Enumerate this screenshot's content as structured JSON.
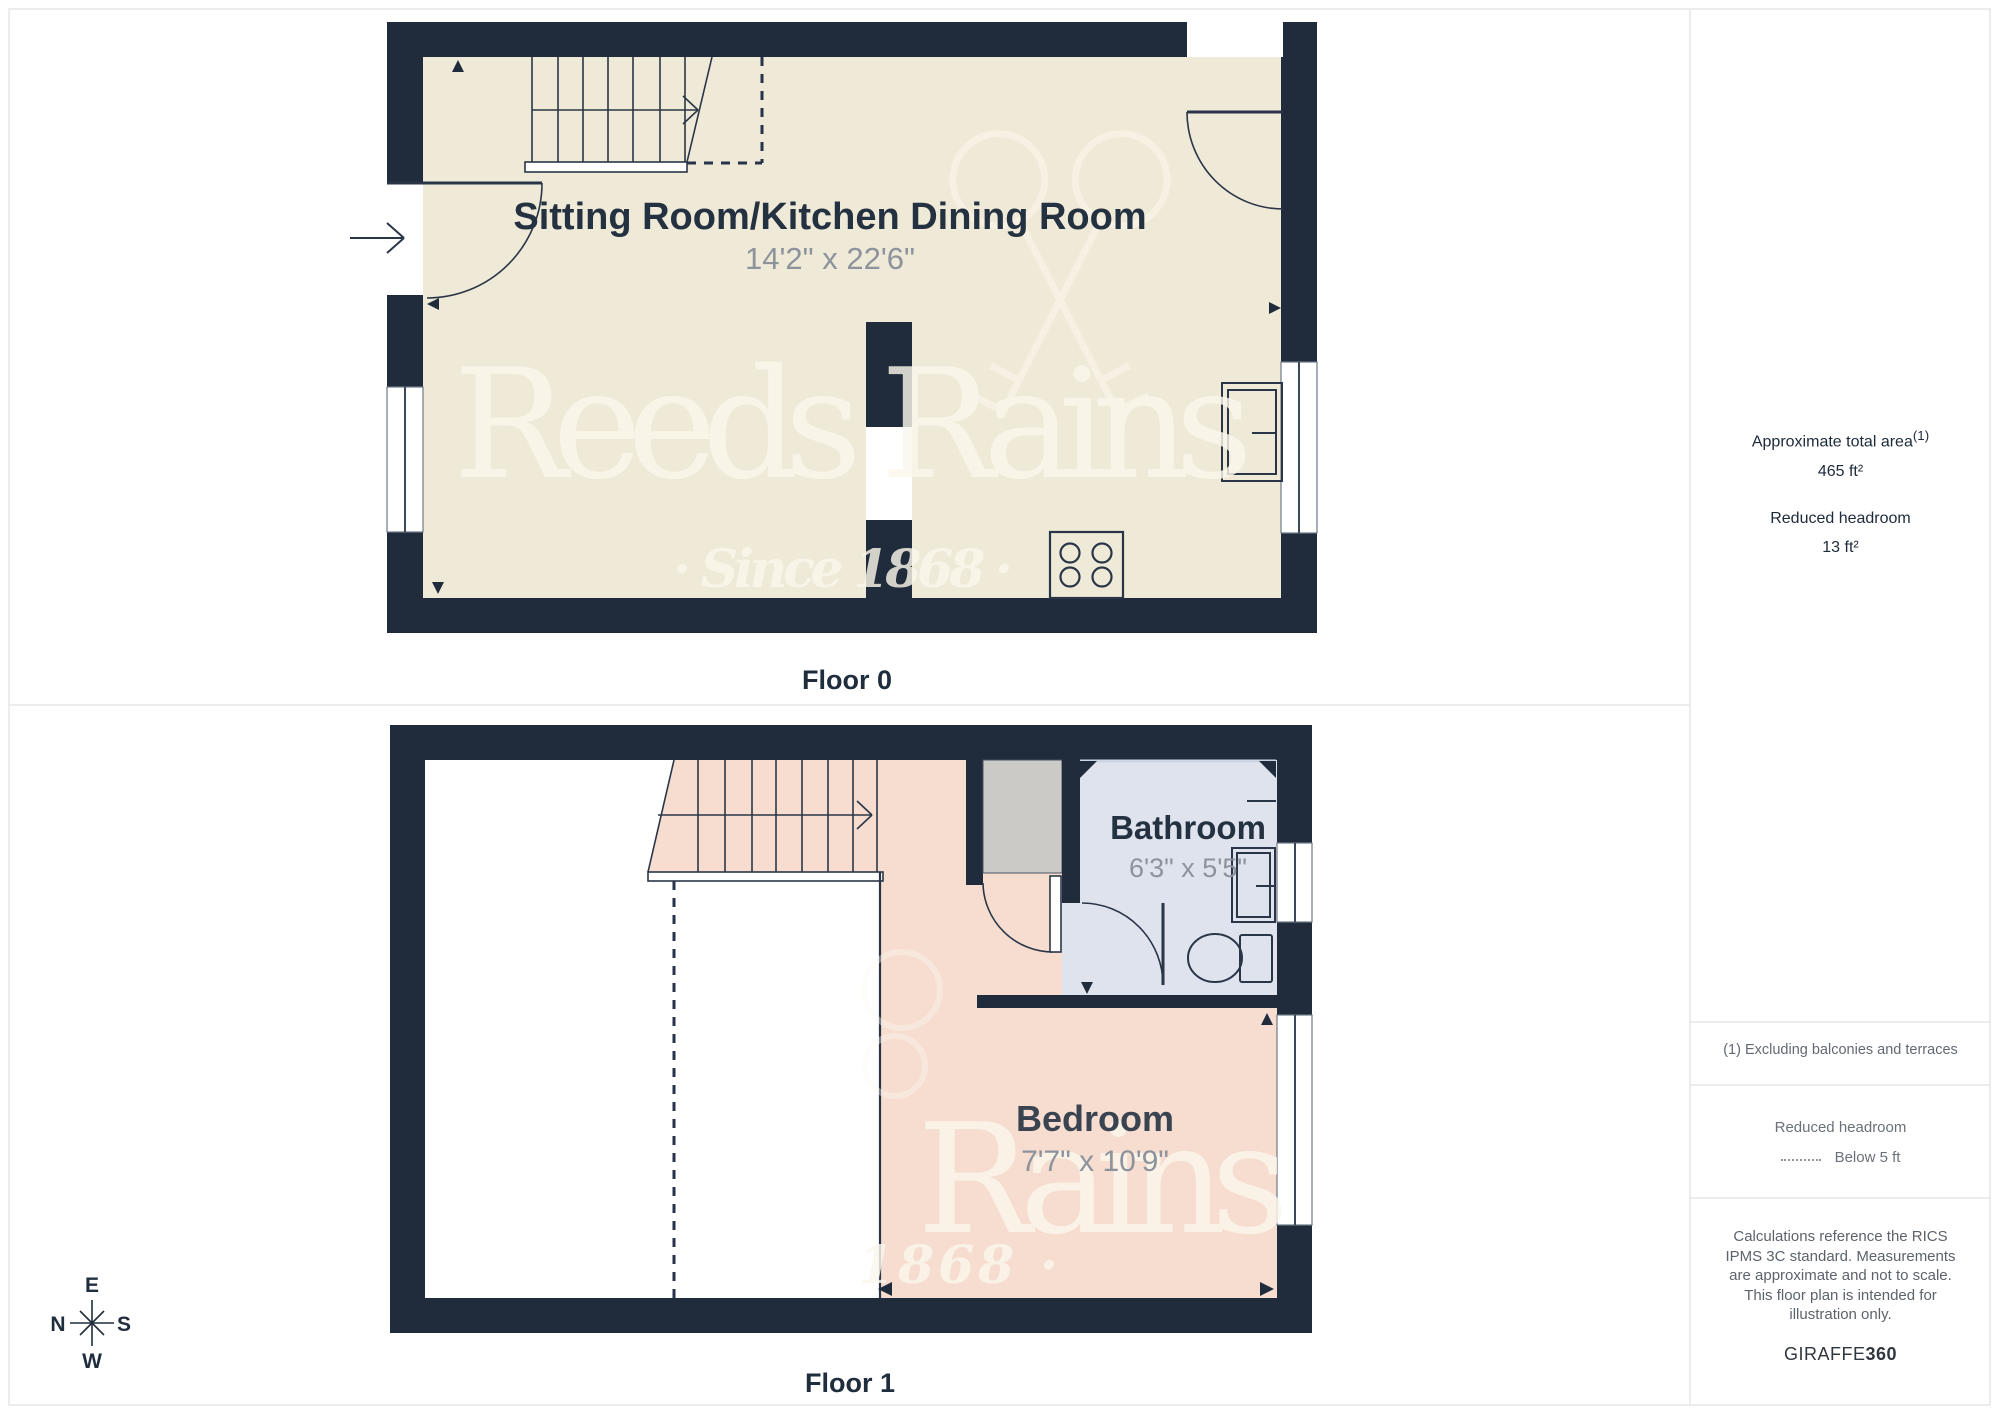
{
  "floors": {
    "floor0": {
      "label": "Floor 0",
      "room": {
        "name": "Sitting Room/Kitchen Dining Room",
        "dims": "14'2\" x 22'6\""
      }
    },
    "floor1": {
      "label": "Floor 1",
      "bathroom": {
        "name": "Bathroom",
        "dims": "6'3\" x 5'5\""
      },
      "bedroom": {
        "name": "Bedroom",
        "dims": "7'7\" x 10'9\""
      }
    }
  },
  "compass": {
    "top": "E",
    "left": "N",
    "right": "S",
    "bottom": "W"
  },
  "watermark": {
    "brand": "Reeds Rains",
    "since": "· Since 1868 ·",
    "brand_partial": "Rains",
    "since_partial": "1868 ·"
  },
  "sidebar": {
    "total_area_label": "Approximate total area",
    "total_area_sup": "(1)",
    "total_area_value": "465 ft²",
    "reduced_label": "Reduced headroom",
    "reduced_value": "13 ft²",
    "note": "(1) Excluding balconies and terraces",
    "legend_label": "Reduced headroom",
    "legend_value": "Below 5 ft",
    "disclaimer": "Calculations reference the RICS IPMS 3C standard. Measurements are approximate and not to scale. This floor plan is intended for illustration only.",
    "brand_name": "GIRAFFE",
    "brand_suffix": "360"
  },
  "colors": {
    "wall": "#202c3b",
    "floor0_fill": "#efe9d7",
    "bedroom_fill": "#f6ddd0",
    "bathroom_fill": "#dfe3ee",
    "chimney_fill": "#cbcac7",
    "label_navy": "#243141",
    "dims_gray": "#8d939c",
    "border_gray": "#e3e6e9",
    "watermark": "#fbf7ec"
  }
}
